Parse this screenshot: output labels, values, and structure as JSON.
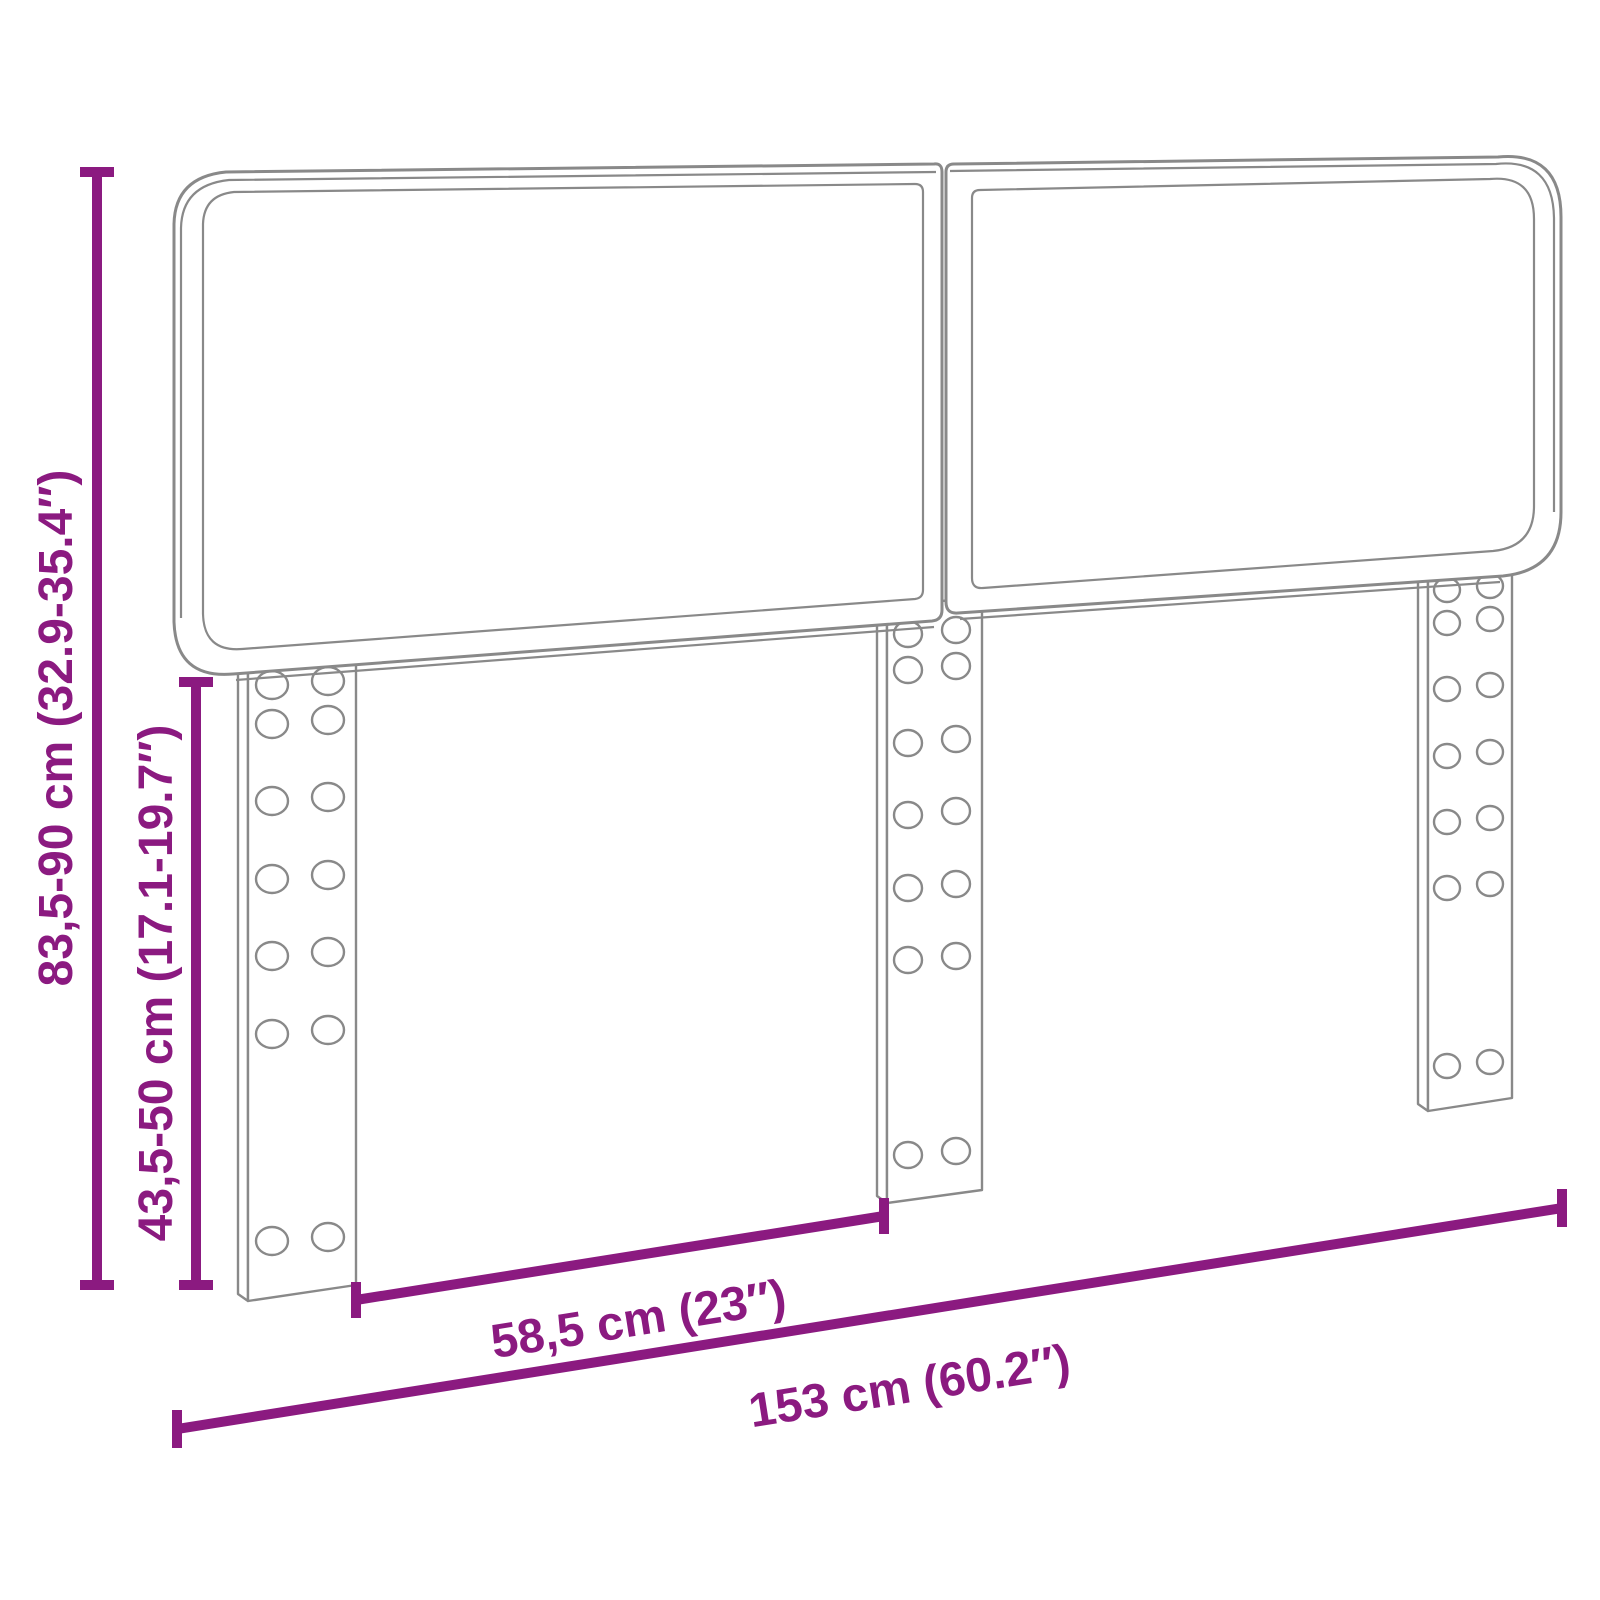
{
  "colors": {
    "dimension_accent": "#8B1A80",
    "drawing_outline": "#898989",
    "background": "#FFFFFF"
  },
  "diagram": {
    "subject": "upholstered-headboard-with-three-mounting-legs",
    "dimensions": {
      "overall_height": {
        "label": "83,5-90 cm (32.9-35.4″)"
      },
      "leg_height": {
        "label": "43,5-50 cm (17.1-19.7″)"
      },
      "partial_width": {
        "label": "58,5 cm (23″)"
      },
      "overall_width": {
        "label": "153 cm (60.2″)"
      }
    }
  }
}
